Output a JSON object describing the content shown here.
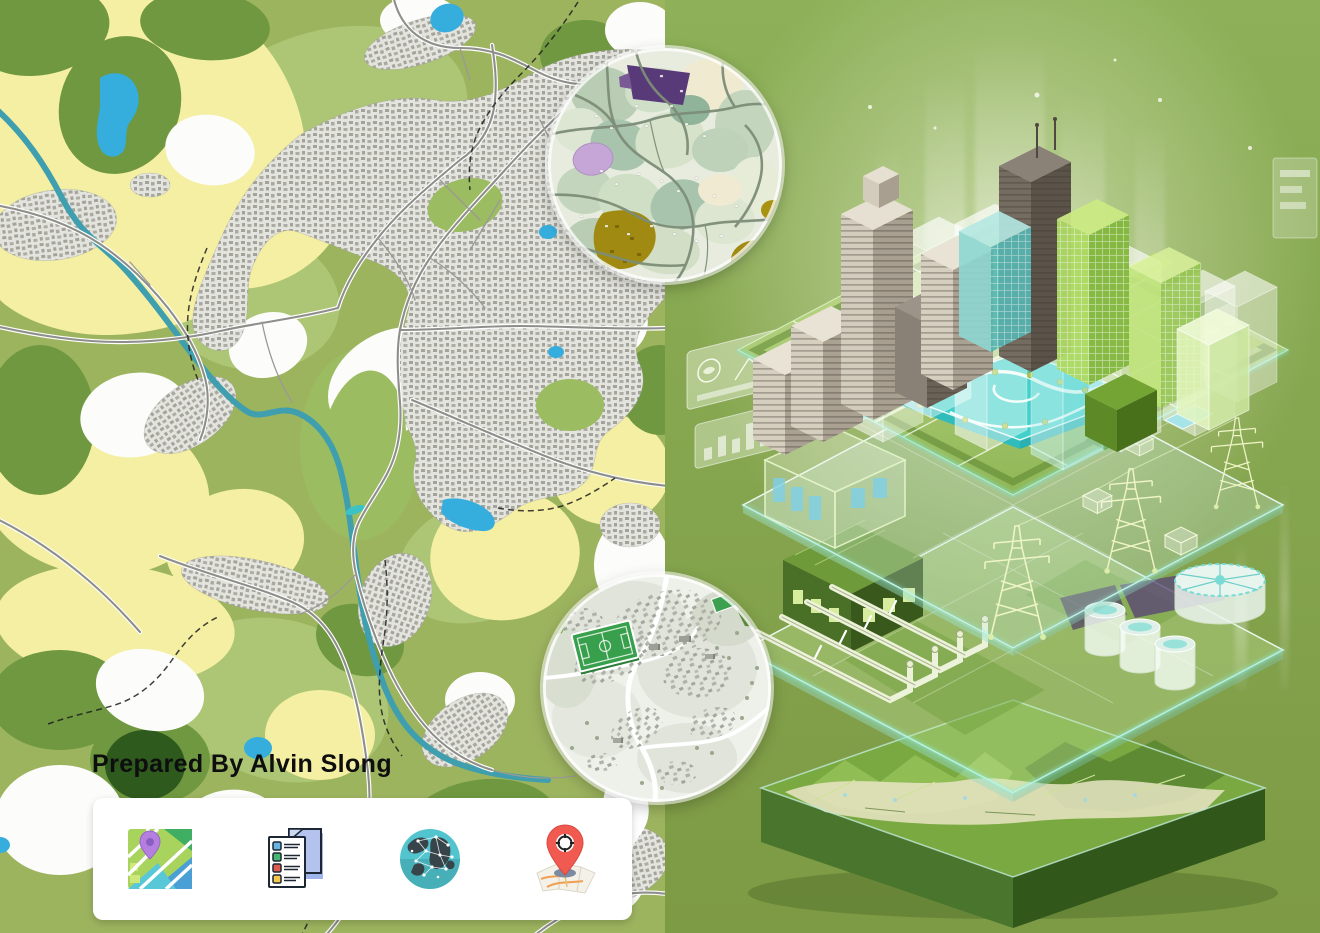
{
  "poster": {
    "prepared_by": "Prepared By Alvin Slong"
  },
  "map_panel": {
    "kind": "land-use-city-map",
    "palette": {
      "fields_yellow": "#f4efa2",
      "land_green": "#9db45f",
      "forest_green": "#6f9840",
      "deep_forest_green": "#2e5a1e",
      "urban_gray": "#a3a39d",
      "river_teal": "#3f9fae",
      "lake_blue": "#35aede"
    }
  },
  "insets": {
    "zoning": {
      "name": "zoning-detail-inset",
      "accent_purple": "#593a78",
      "accent_mustard": "#a08a12"
    },
    "village": {
      "name": "village-3d-inset",
      "pitch_green": "#38a04c"
    }
  },
  "footer": {
    "icons": [
      {
        "name": "map-icon"
      },
      {
        "name": "documents-icon"
      },
      {
        "name": "globe-network-icon"
      },
      {
        "name": "map-pin-icon"
      }
    ]
  },
  "illustration": {
    "name": "gis-layer-stack",
    "background_green": "#87a44c",
    "glow_cyan": "#8ff0e0",
    "layers": [
      "city-buildings-layer",
      "surface-water-park-layer",
      "power-grid-layer",
      "utility-pipes-layer",
      "terrain-layer"
    ]
  }
}
